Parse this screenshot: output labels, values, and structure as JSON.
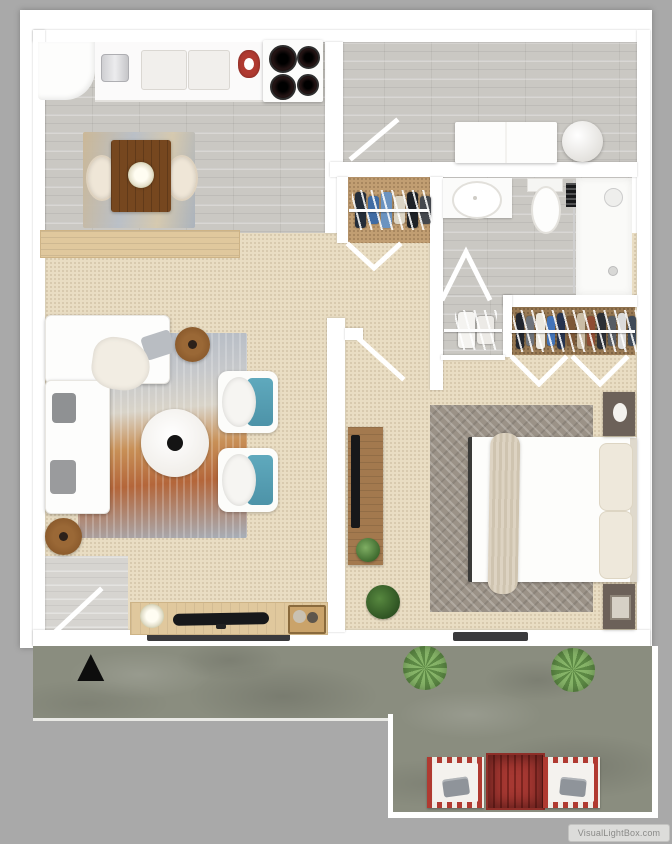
{
  "meta": {
    "watermark": "VisualLightBox.com"
  },
  "patio": {
    "marker_glyph": "▲"
  },
  "colors": {
    "background": "#a9a9a9",
    "wall": "#ffffff",
    "wood_floor": "#cac8c3",
    "carpet": "#e9ddc3",
    "closet_tan": "#c19e72",
    "closet_dark": "#9a7b55",
    "patio_concrete": "#8a8d7f",
    "accent_red": "#b03a31",
    "teal_cushion": "#5fa9bd",
    "table_wood_dark": "#76471f",
    "furniture_wood": "#a3794e",
    "console_wood_light": "#e0c89d",
    "bed_rug_gray": "#9b9287",
    "nightstand_taupe": "#6c6159",
    "plant_green": "#4c7a38",
    "bush_green": "#86b468",
    "appliance_black": "#17181a",
    "door_mat": "#3a3a3c",
    "watermark_bg": "#dcdcda",
    "watermark_text": "#8a8a88"
  },
  "closets": {
    "entry_clothes": [
      "#232c38",
      "#3f6ba3",
      "#6b93c0",
      "#ddd6c6",
      "#1e2126",
      "#44474d"
    ],
    "bedroom_clothes": [
      "#22262e",
      "#6e737a",
      "#ece8de",
      "#4273b8",
      "#26334e",
      "#7c5736",
      "#cbbda6",
      "#8e4c33",
      "#2c2f35",
      "#585d64",
      "#dcdcdc",
      "#3f4a58"
    ],
    "linen_items": [
      "#f4f3f0",
      "#eceae6"
    ]
  }
}
